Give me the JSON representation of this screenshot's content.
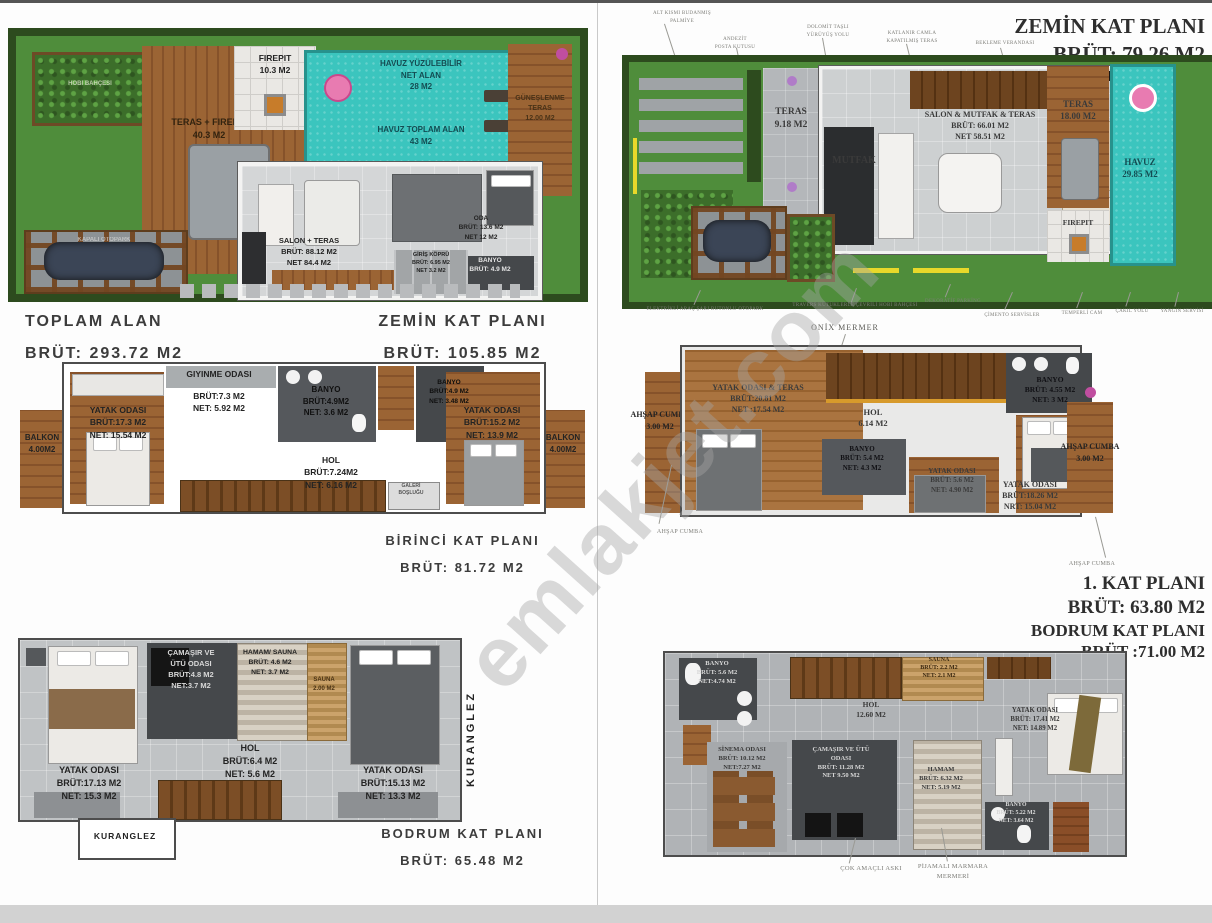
{
  "watermark": "emlakjet.com",
  "left": {
    "site": {
      "hobby_garden": "HOBİ BAHÇESİ",
      "carport": "KAPALI OTOPARK",
      "teras_firepit": "TERAS + FIREPIT\n40.3 M2",
      "firepit": "FIREPIT\n10.3 M2",
      "pool_swim": "HAVUZ YÜZÜLEBİLİR\nNET ALAN\n28 M2",
      "pool_total": "HAVUZ TOPLAM ALAN\n43 M2",
      "sun_terrace": "GÜNEŞLENME\nTERAS\n12.00 M2",
      "salon": "SALON + TERAS\nBRÜT: 88.12 M2\nNET 84.4 M2",
      "oda": "ODA\nBRÜT: 13.6 M2\nNET 12 M2",
      "banyo": "BANYO\nBRÜT: 4.9 M2",
      "entry": "GİRİŞ KÖPRÜ\nBRÜT: 6.95 M2\nNET 3.2 M2",
      "caption_total": "TOPLAM ALAN\nBRÜT: 293.72 M2",
      "caption_plan": "ZEMİN KAT PLANI\nBRÜT: 105.85 M2"
    },
    "first": {
      "balkon_left": "BALKON\n4.00M2",
      "balkon_right": "BALKON\n4.00M2",
      "bedroom_left": "YATAK ODASI\nBRÜT:17.3 M2\nNET: 15.54 M2",
      "dressing_title": "GIYINME ODASI",
      "dressing_area": "BRÜT:7.3 M2\nNET: 5.92 M2",
      "banyo1": "BANYO\nBRÜT:4.9M2\nNET: 3.6 M2",
      "banyo2": "BANYO\nBRÜT:4.9 M2\nNET: 3.48 M2",
      "hol": "HOL\nBRÜT:7.24M2\nNET: 6.16 M2",
      "bedroom_right": "YATAK ODASI\nBRÜT:15.2 M2\nNET: 13.9 M2",
      "gallery": "GALERİ\nBOŞLUĞU",
      "caption": "BİRİNCİ KAT PLANI\nBRÜT: 81.72 M2"
    },
    "basement": {
      "bedroom_left": "YATAK ODASI\nBRÜT:17.13 M2\nNET: 15.3 M2",
      "laundry": "ÇAMAŞIR VE\nÜTÜ ODASI\nBRÜT:4.8 M2\nNET:3.7 M2",
      "hamam": "HAMAM/ SAUNA\nBRÜT: 4.6 M2\nNET: 3.7 M2",
      "sauna": "SAUNA\n2.00 M2",
      "hol": "HOL\nBRÜT:6.4 M2\nNET: 5.6 M2",
      "bedroom_right": "YATAK ODASI\nBRÜT:15.13 M2\nNET: 13.3 M2",
      "kuranglez_side": "KURANGLEZ",
      "kuranglez_box": "KURANGLEZ",
      "caption": "BODRUM KAT PLANI\nBRÜT: 65.48 M2"
    }
  },
  "right": {
    "ground": {
      "title": "ZEMİN KAT PLANI\nBRÜT: 79.26 M2",
      "ann_top_1": "ALT KISMI BUDANMIŞ\nPALMİYE",
      "ann_top_2": "ANDEZİT\nPOSTA KUTUSU",
      "ann_top_3": "DOLOMİT TAŞLI\nYÜRÜYÜŞ YOLU",
      "ann_top_4": "KATLANIR CAMLA\nKAPATILMIŞ TERAS",
      "ann_top_5": "BEKLEME VERANDASI",
      "teras_small": "TERAS\n9.18 M2",
      "mutfak": "MUTFAK",
      "salon": "SALON & MUTFAK & TERAS\nBRÜT: 66.01 M2\nNET 58.51 M2",
      "teras_big": "TERAS\n18.00 M2",
      "havuz": "HAVUZ\n29.85 M2",
      "firepit": "FIREPIT",
      "ann_bot_1": "ELEKTRİKLİ ARAÇ ŞARJ BUTONLU OTOPARK",
      "ann_bot_2": "TRAVERS KÜTÜKLERLE ÇEVRİLİ HOBİ BAHÇESİ",
      "ann_bot_3": "DEKORATİF PARKİNG",
      "ann_bot_4": "ÇİMENTO SERVİSLER",
      "ann_bot_5": "TEMPERLİ CAM",
      "ann_bot_6": "ÇAKIL YOLU",
      "ann_bot_7": "YANGIN SERVİSİ"
    },
    "first": {
      "onix": "ONİX MERMER",
      "cumba_left": "AHŞAP CUMBA\n3.00 M2",
      "cumba_right": "AHŞAP CUMBA\n3.00 M2",
      "bedroom_teras": "YATAK ODASI & TERAS\nBRÜT:20.81 M2\nNET :17.54 M2",
      "hol": "HOL\n6.14 M2",
      "banyo1": "BANYO\nBRÜT: 4.55 M2\nNET: 3 M2",
      "banyo2": "BANYO\nBRÜT: 5.4 M2\nNET: 4.3 M2",
      "bedroom_mid": "YATAK ODASI\nBRÜT: 5.6 M2\nNET: 4.90 M2",
      "bedroom_right": "YATAK ODASI\nBRÜT:18.26 M2\nNRT: 15.04 M2",
      "ann_left": "AHŞAP CUMBA",
      "ann_right": "AHŞAP CUMBA",
      "caption": "1. KAT PLANI\nBRÜT: 63.80 M2",
      "caption_basement": "BODRUM KAT PLANI\nBRÜT :71.00 M2"
    },
    "basement": {
      "banyo_top": "BANYO\nBRÜT: 5.6 M2\nNET:4.74 M2",
      "sauna": "SAUNA\nBRÜT: 2.2 M2\nNET: 2.1 M2",
      "hol": "HOL\n12.60 M2",
      "bedroom": "YATAK ODASI\nBRÜT: 17.41 M2\nNET: 14.89 M2",
      "cinema": "SİNEMA ODASI\nBRÜT: 10.12 M2\nNET:7.27 M2",
      "laundry": "ÇAMAŞIR VE ÜTÜ\nODASI\nBRÜT: 11.28 M2\nNET 9.50 M2",
      "hamam": "HAMAM\nBRÜT: 6.32 M2\nNET: 5.19 M2",
      "banyo_bottom": "BANYO\nBRÜT: 5.22 M2\nNET: 3.64 M2",
      "ann_hanger": "ÇOK AMAÇLI ASKI",
      "ann_marble": "PİJAMALI MARMARA\nMERMERİ"
    }
  }
}
